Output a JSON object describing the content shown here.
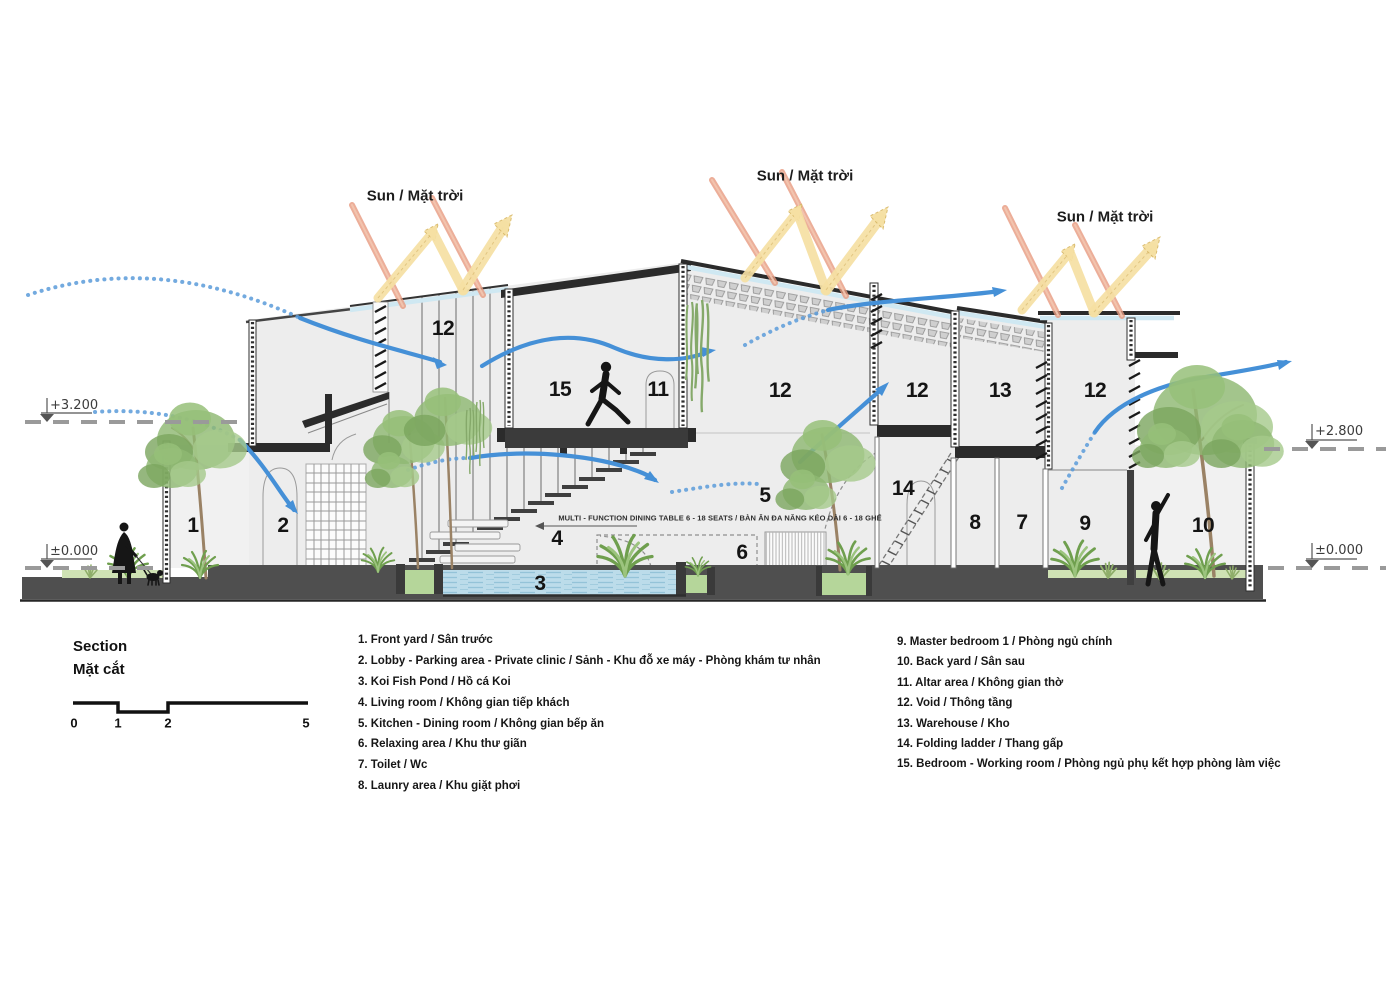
{
  "sun_labels": [
    "Sun / Mặt trời",
    "Sun / Mặt trời",
    "Sun / Mặt trời"
  ],
  "levels": {
    "left_top": "+3.200",
    "left_ground": "±0.000",
    "right_top": "+2.800",
    "right_ground": "±0.000"
  },
  "table_note": "MULTI - FUNCTION DINING TABLE 6 - 18 SEATS / BÀN ĂN ĐA NĂNG KÉO DÀI 6 - 18 GHẾ",
  "room_markers": [
    "1",
    "2",
    "3",
    "4",
    "5",
    "6",
    "12",
    "15",
    "11",
    "12",
    "12",
    "13",
    "12",
    "14",
    "8",
    "7",
    "9",
    "10"
  ],
  "section_title": {
    "en": "Section",
    "vi": "Mặt cắt"
  },
  "scale_ticks": [
    "0",
    "1",
    "2",
    "5"
  ],
  "legend_left": [
    "1. Front yard / Sân trước",
    "2. Lobby - Parking area - Private clinic / Sảnh - Khu đỗ xe máy - Phòng khám tư nhân",
    "3. Koi Fish Pond / Hồ cá Koi",
    "4. Living room / Không gian tiếp khách",
    "5. Kitchen - Dining room / Không gian bếp ăn",
    "6. Relaxing area / Khu thư giãn",
    "7. Toilet / Wc",
    "8. Launry area / Khu giặt phơi"
  ],
  "legend_right": [
    "9. Master bedroom 1 / Phòng ngủ chính",
    "10. Back yard / Sân sau",
    "11. Altar area / Không gian thờ",
    "12. Void / Thông tầng",
    "13. Warehouse / Kho",
    "14. Folding ladder / Thang gấp",
    "15. Bedroom - Working room / Phòng ngủ phụ kết hợp phòng làm việc"
  ],
  "colors": {
    "airflow": "#4590d7",
    "sun_ray": "#e89b80",
    "sun_reflect": "#f5e0a3",
    "glazing": "#cfe8f2",
    "water": "#bcdcea",
    "wall_fill": "#ededed",
    "slab": "#2b2b2b",
    "ground": "#4f4f4f",
    "planter": "#b5d69a",
    "foliage": "#8fb873"
  }
}
